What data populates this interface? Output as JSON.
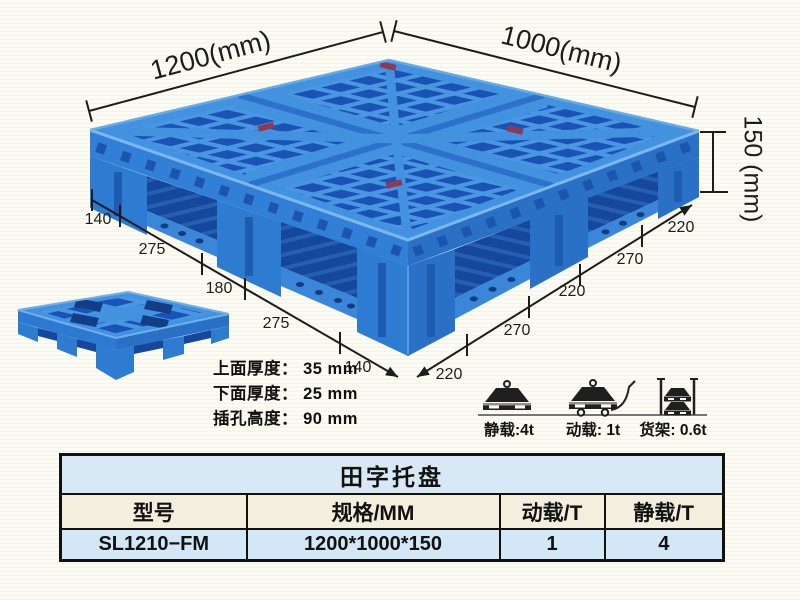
{
  "dimensions": {
    "width_label": "1200(mm)",
    "depth_label": "1000(mm)",
    "height_label": "150 (mm)",
    "left_edge_segments": [
      "140",
      "275",
      "180",
      "275",
      "140"
    ],
    "right_edge_segments": [
      "220",
      "270",
      "220",
      "270",
      "220"
    ]
  },
  "thickness_notes": [
    "上面厚度： 35 mm",
    "下面厚度： 25 mm",
    "插孔高度： 90 mm"
  ],
  "load_ratings": [
    {
      "icon": "static-load-icon",
      "label": "静载:4t"
    },
    {
      "icon": "dynamic-load-icon",
      "label": "动载: 1t"
    },
    {
      "icon": "rack-load-icon",
      "label": "货架: 0.6t"
    }
  ],
  "spec_table": {
    "title": "田字托盘",
    "headers": [
      "型号",
      "规格/MM",
      "动载/T",
      "静载/T"
    ],
    "rows": [
      [
        "SL1210−FM",
        "1200*1000*150",
        "1",
        "4"
      ]
    ]
  },
  "colors": {
    "pallet_blue": "#2e7cd2",
    "pallet_dark_blue": "#1a53b4",
    "pallet_rib_light": "#4392e0",
    "sticker_red": "#8e3a55",
    "dimension_line": "#1c1c1c",
    "background": "#fbfaf0",
    "table_title_bg": "#d7e9f5",
    "table_header_bg": "#f3eedd",
    "table_row_bg": "#d3e8f6"
  }
}
